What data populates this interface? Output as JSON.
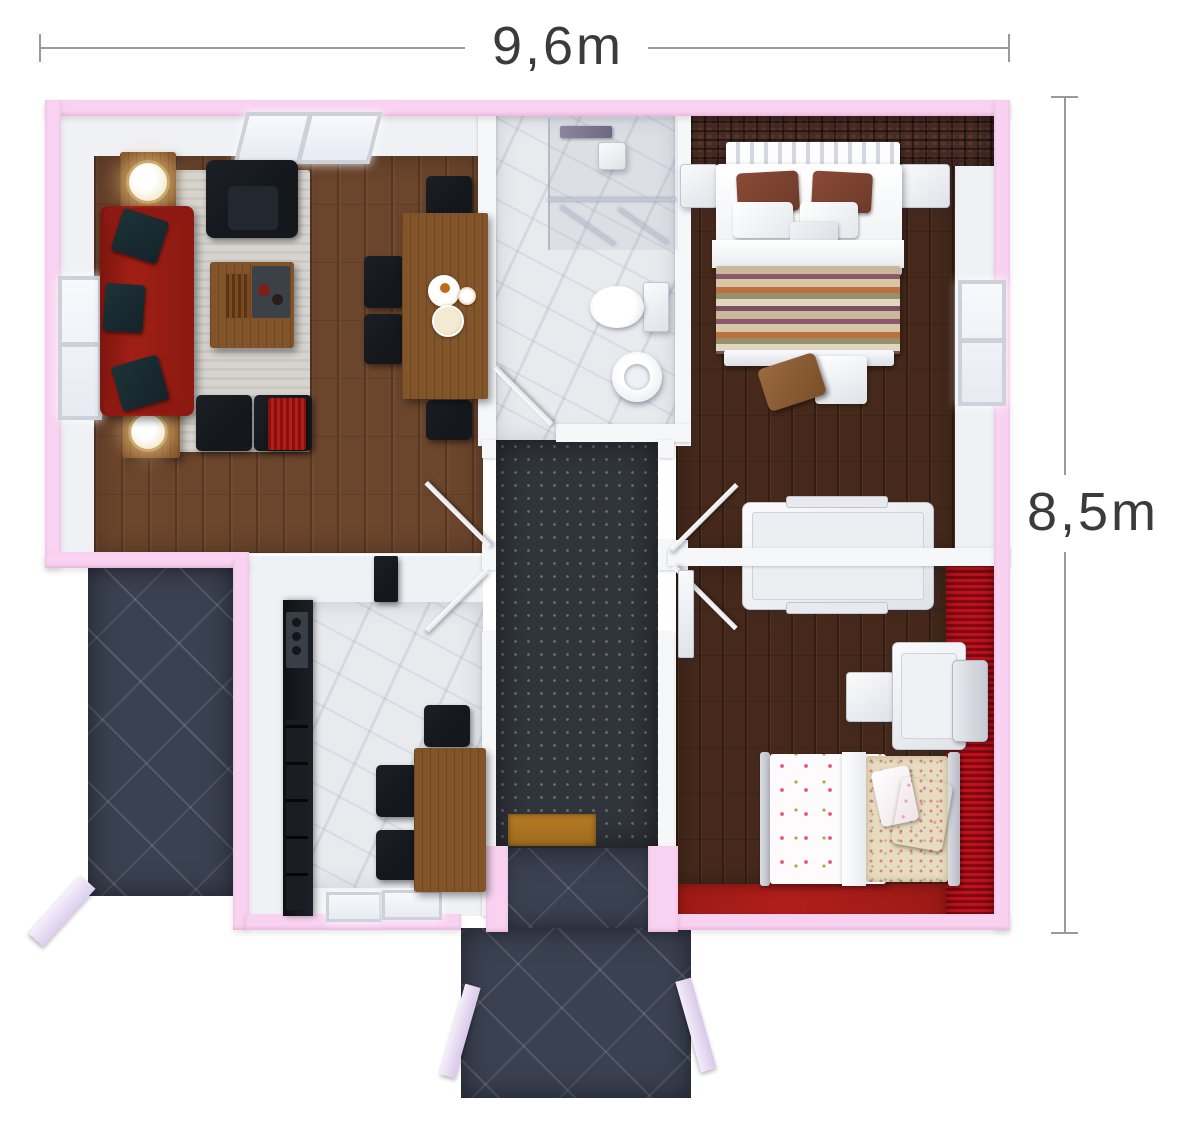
{
  "dimension_labels": {
    "width": "9,6m",
    "height": "8,5m"
  },
  "colors": {
    "dim_line": "#9a9a9a",
    "dim_text": "#3b3b3b",
    "wall_pink": "#f8d2f0",
    "wall_white": "#f6f7f9",
    "wood_living": "#6b452c",
    "wood_dark": "#46291b",
    "marble_light": "#e9eaee",
    "slate_dark": "#3a4150",
    "hall_dark": "#30343b",
    "brick_dark": "#452c24",
    "red_wall": "#c0121c",
    "carpet_red": "#b01e1a",
    "sofa_red": "#a11f15",
    "furniture_black": "#14171b",
    "wood_table": "#82542a",
    "rug_grey": "#d7d4cf",
    "accent_gold": "#c9a96a",
    "pillow_teal": "#132329",
    "doormat_brown": "#a06a1e"
  }
}
